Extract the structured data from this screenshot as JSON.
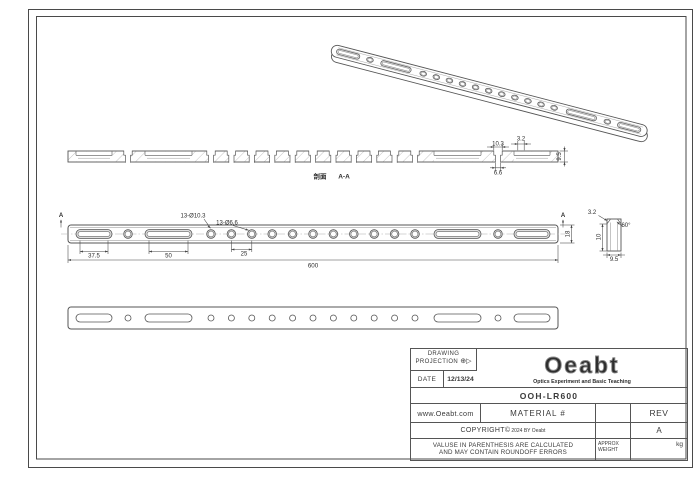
{
  "colors": {
    "line": "#565656",
    "dim_text": "#2e2e2e",
    "counterbore_fill": "#e0e0e0",
    "background": "#ffffff"
  },
  "views": {
    "section": {
      "label_cn": "剖面",
      "label": "A-A",
      "dim_cbore_w": "10.3",
      "dim_thru_w": "6.6",
      "dim_chamfer": "3.2",
      "dim_thickness": "9.5"
    },
    "front": {
      "section_arrow": "A",
      "callout_cbore": "13-Ø10.3",
      "callout_thru": "13-Ø6.6",
      "dim_slot1": "37.5",
      "dim_slot2": "50",
      "dim_pitch": "25",
      "dim_length": "600",
      "dim_width": "18"
    },
    "end": {
      "dim_chamfer": "3.2",
      "dim_angle": "60°",
      "dim_height": "10",
      "dim_width": "9.5"
    }
  },
  "title_block": {
    "drawing_label": "DRAWING",
    "projection_label": "PROJECTION",
    "projection_symbol_circle": "⊕",
    "projection_symbol_cone": "▷",
    "date_label": "DATE",
    "date_value": "12/13/24",
    "logo_text": "Oeabt",
    "logo_tagline": "Optics Experiment and Basic Teaching",
    "part_number": "OOH-LR600",
    "website": "www.Oeabt.com",
    "material_label": "MATERIAL #",
    "rev_label": "REV",
    "rev_value": "A",
    "copyright_main": "COPYRIGHT©",
    "copyright_sub": "2024 BY Oeabt",
    "disclaimer_line1": "VALUSE IN PARENTHESIS ARE CALCULATED",
    "disclaimer_line2": "AND MAY CONTAIN ROUNDOFF ERRORS",
    "weight_label_1": "APPROX",
    "weight_label_2": "WEIGHT",
    "weight_unit": "kg"
  }
}
